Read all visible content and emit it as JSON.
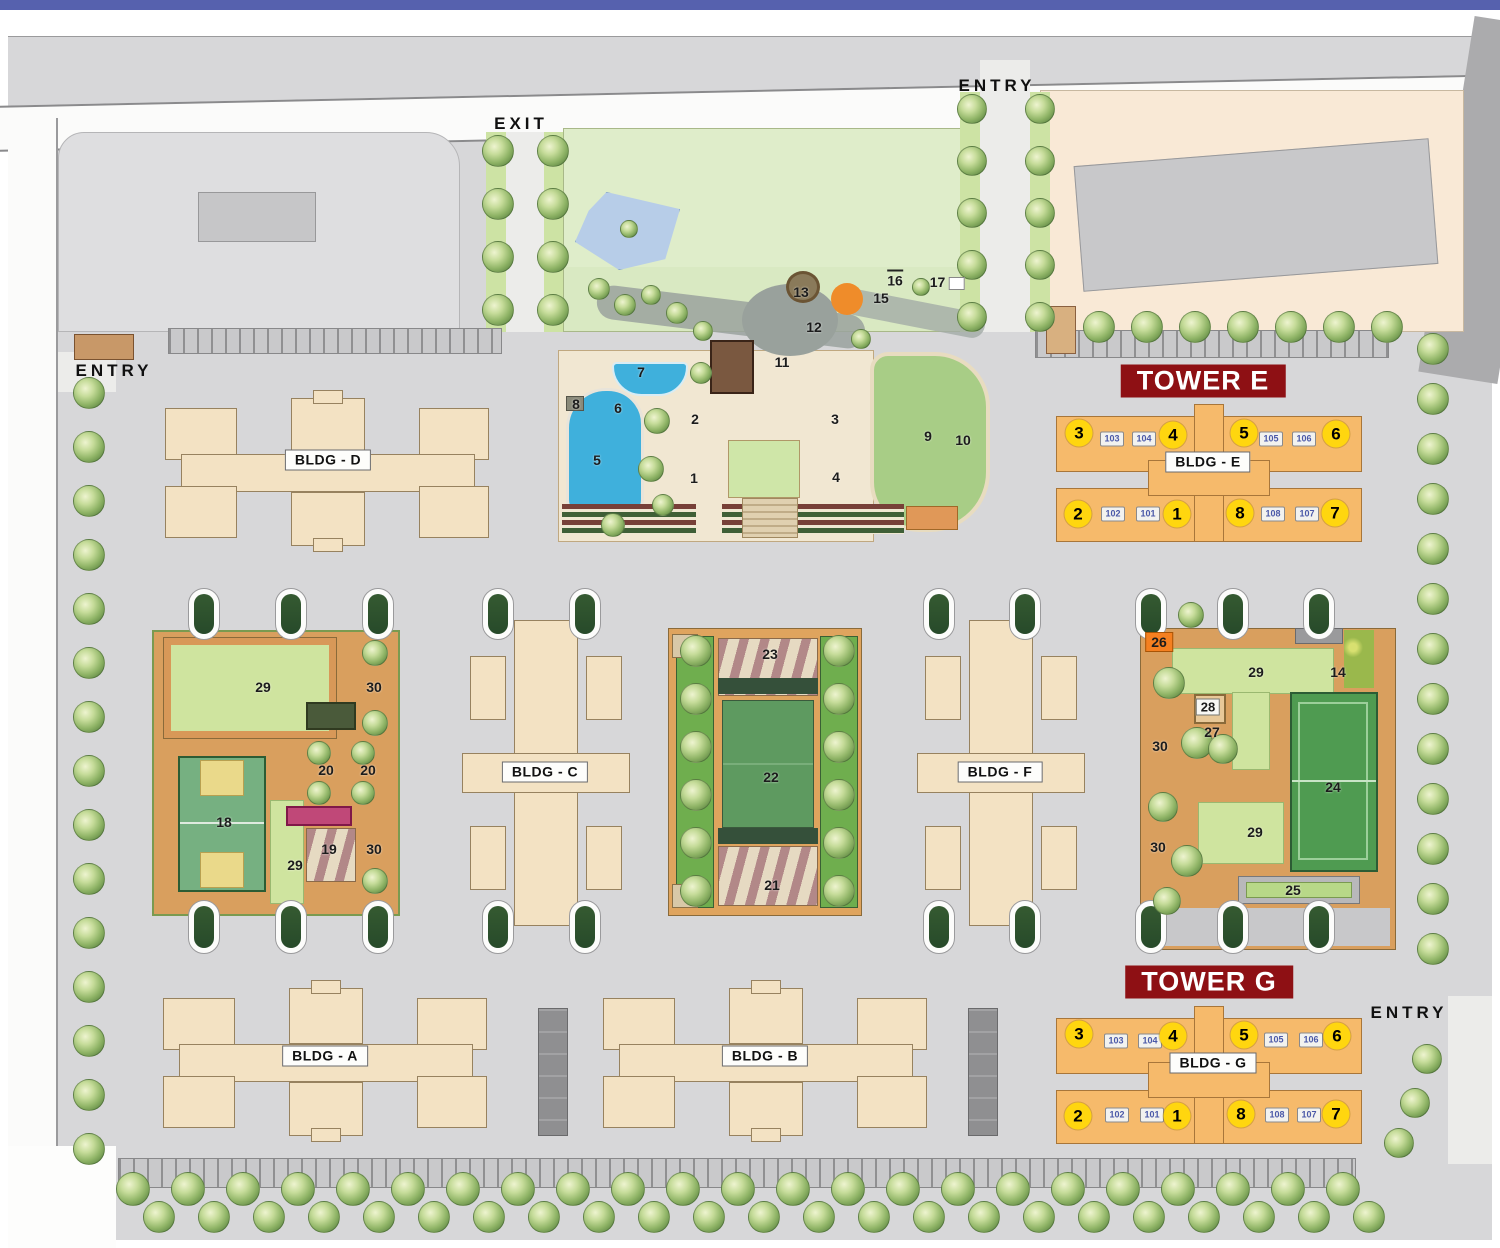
{
  "page": {
    "top_bar_color": "#5661ae",
    "banner_color": "#8e1014",
    "unit_circle_color": "#ffd60f",
    "tower_building_color": "#f6ba6b",
    "building_color": "#f3e2c3",
    "pool_color": "#3fb0dc"
  },
  "map": {
    "road_labels": [
      {
        "text": "ENTRY",
        "x": 997,
        "y": 86
      },
      {
        "text": "EXIT",
        "x": 521,
        "y": 124
      },
      {
        "text": "ENTRY",
        "x": 114,
        "y": 371
      },
      {
        "text": "ENTRY",
        "x": 1409,
        "y": 1013
      }
    ],
    "tower_banners": [
      {
        "text": "TOWER E",
        "x": 1203,
        "y": 381
      },
      {
        "text": "TOWER G",
        "x": 1209,
        "y": 982
      }
    ],
    "building_labels": [
      {
        "text": "BLDG - D",
        "x": 328,
        "y": 460
      },
      {
        "text": "BLDG - E",
        "x": 1208,
        "y": 462
      },
      {
        "text": "BLDG - C",
        "x": 545,
        "y": 772
      },
      {
        "text": "BLDG - F",
        "x": 1000,
        "y": 772
      },
      {
        "text": "BLDG - A",
        "x": 325,
        "y": 1056
      },
      {
        "text": "BLDG - B",
        "x": 765,
        "y": 1056
      },
      {
        "text": "BLDG - G",
        "x": 1213,
        "y": 1063
      }
    ],
    "unit_circles": [
      {
        "n": "3",
        "x": 1079,
        "y": 433
      },
      {
        "n": "4",
        "x": 1173,
        "y": 435
      },
      {
        "n": "5",
        "x": 1244,
        "y": 433
      },
      {
        "n": "6",
        "x": 1336,
        "y": 434
      },
      {
        "n": "2",
        "x": 1078,
        "y": 514
      },
      {
        "n": "1",
        "x": 1177,
        "y": 514
      },
      {
        "n": "8",
        "x": 1240,
        "y": 513
      },
      {
        "n": "7",
        "x": 1335,
        "y": 513
      },
      {
        "n": "3",
        "x": 1079,
        "y": 1034
      },
      {
        "n": "4",
        "x": 1173,
        "y": 1036
      },
      {
        "n": "5",
        "x": 1244,
        "y": 1035
      },
      {
        "n": "6",
        "x": 1337,
        "y": 1036
      },
      {
        "n": "2",
        "x": 1078,
        "y": 1116
      },
      {
        "n": "1",
        "x": 1177,
        "y": 1116
      },
      {
        "n": "8",
        "x": 1241,
        "y": 1114
      },
      {
        "n": "7",
        "x": 1336,
        "y": 1114
      }
    ],
    "unit_badges": [
      {
        "n": "103",
        "x": 1112,
        "y": 439
      },
      {
        "n": "104",
        "x": 1144,
        "y": 439
      },
      {
        "n": "105",
        "x": 1271,
        "y": 439
      },
      {
        "n": "106",
        "x": 1304,
        "y": 439
      },
      {
        "n": "102",
        "x": 1113,
        "y": 514
      },
      {
        "n": "101",
        "x": 1148,
        "y": 514
      },
      {
        "n": "108",
        "x": 1273,
        "y": 514
      },
      {
        "n": "107",
        "x": 1307,
        "y": 514
      },
      {
        "n": "103",
        "x": 1116,
        "y": 1041
      },
      {
        "n": "104",
        "x": 1150,
        "y": 1041
      },
      {
        "n": "105",
        "x": 1276,
        "y": 1040
      },
      {
        "n": "106",
        "x": 1311,
        "y": 1040
      },
      {
        "n": "102",
        "x": 1117,
        "y": 1115
      },
      {
        "n": "101",
        "x": 1152,
        "y": 1115
      },
      {
        "n": "108",
        "x": 1277,
        "y": 1115
      },
      {
        "n": "107",
        "x": 1309,
        "y": 1115
      }
    ],
    "amenity_markers": [
      {
        "n": "1",
        "x": 694,
        "y": 478
      },
      {
        "n": "2",
        "x": 695,
        "y": 419
      },
      {
        "n": "3",
        "x": 835,
        "y": 419
      },
      {
        "n": "4",
        "x": 836,
        "y": 477
      },
      {
        "n": "5",
        "x": 597,
        "y": 460
      },
      {
        "n": "6",
        "x": 618,
        "y": 408
      },
      {
        "n": "7",
        "x": 641,
        "y": 372
      },
      {
        "n": "8",
        "x": 576,
        "y": 404
      },
      {
        "n": "9",
        "x": 928,
        "y": 436
      },
      {
        "n": "10",
        "x": 963,
        "y": 440
      },
      {
        "n": "11",
        "x": 782,
        "y": 362
      },
      {
        "n": "12",
        "x": 814,
        "y": 327
      },
      {
        "n": "13",
        "x": 801,
        "y": 292
      },
      {
        "n": "15",
        "x": 881,
        "y": 298
      },
      {
        "n": "16",
        "x": 895,
        "y": 279,
        "style": "overline"
      },
      {
        "n": "17",
        "x": 947,
        "y": 282,
        "style": "boxright"
      },
      {
        "n": "18",
        "x": 224,
        "y": 822
      },
      {
        "n": "19",
        "x": 329,
        "y": 849
      },
      {
        "n": "20",
        "x": 326,
        "y": 770
      },
      {
        "n": "20",
        "x": 368,
        "y": 770
      },
      {
        "n": "21",
        "x": 772,
        "y": 885
      },
      {
        "n": "22",
        "x": 771,
        "y": 777
      },
      {
        "n": "23",
        "x": 770,
        "y": 654
      },
      {
        "n": "24",
        "x": 1333,
        "y": 787
      },
      {
        "n": "25",
        "x": 1293,
        "y": 890
      },
      {
        "n": "26",
        "x": 1159,
        "y": 642,
        "style": "orange"
      },
      {
        "n": "27",
        "x": 1212,
        "y": 732
      },
      {
        "n": "28",
        "x": 1208,
        "y": 707,
        "style": "badge"
      },
      {
        "n": "29",
        "x": 263,
        "y": 687
      },
      {
        "n": "29",
        "x": 295,
        "y": 865
      },
      {
        "n": "29",
        "x": 1256,
        "y": 672
      },
      {
        "n": "29",
        "x": 1255,
        "y": 832
      },
      {
        "n": "30",
        "x": 374,
        "y": 687
      },
      {
        "n": "30",
        "x": 374,
        "y": 849
      },
      {
        "n": "30",
        "x": 1160,
        "y": 746
      },
      {
        "n": "30",
        "x": 1158,
        "y": 847
      },
      {
        "n": "14",
        "x": 1338,
        "y": 672
      }
    ]
  }
}
